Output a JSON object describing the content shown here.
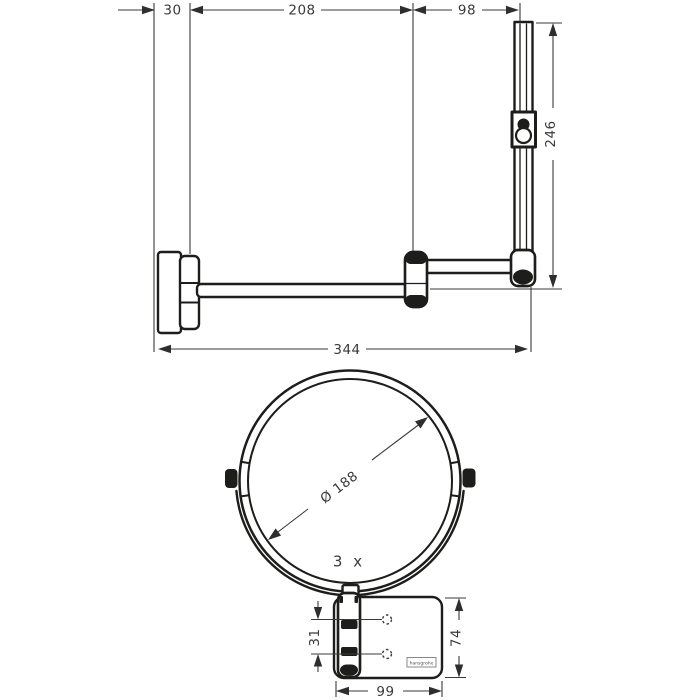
{
  "drawing": {
    "colors": {
      "outline": "#1d1d1b",
      "dimension": "#3a3a38",
      "background": "#ffffff"
    },
    "side_view": {
      "dim_wall_depth": "30",
      "dim_arm_length": "208",
      "dim_bar_offset": "98",
      "dim_bar_height": "246",
      "dim_total_reach": "344"
    },
    "front_view": {
      "dim_mirror_diameter": "Ø 188",
      "magnification": "3 x",
      "dim_hole_spacing": "31",
      "dim_plate_height": "74",
      "dim_plate_width": "99",
      "logo": "hansgrohe"
    }
  }
}
